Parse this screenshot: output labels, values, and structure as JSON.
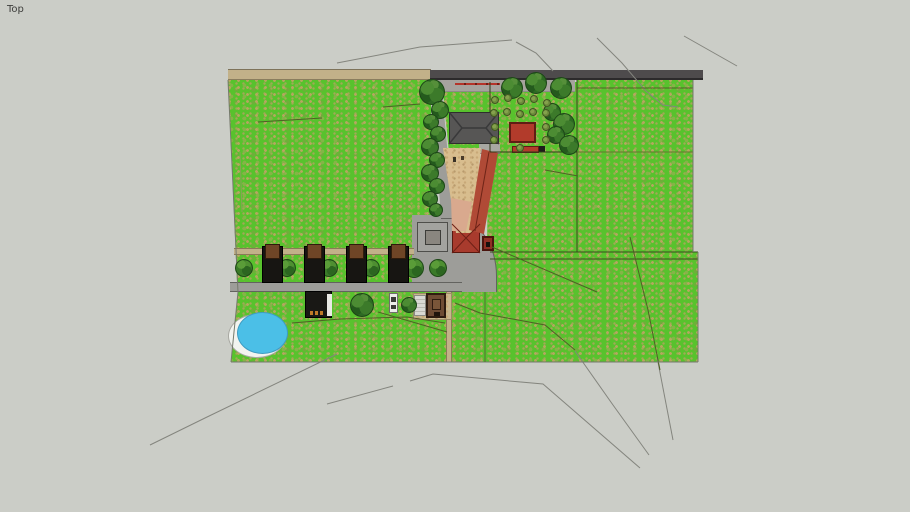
{
  "viewport": {
    "label": "Top"
  },
  "colors": {
    "background": "#cbcdc7",
    "label": "#3e3e3c",
    "grass": "#58c22d",
    "dirt_road": "#c2b189",
    "asphalt": "#4e4b4c",
    "road_gray": "#9d9d99",
    "pavement": "#a6a39e",
    "roof_gray": "#575655",
    "barn_red": "#b23b2b",
    "roof_red_light": "#cf8b74",
    "roof_red": "#b04a36",
    "courtyard_tan": "#d8bd8e",
    "terrace_pink": "#d9a98e",
    "pool_blue": "#4bbfe7",
    "shrub_olive": "#6e8c3c",
    "stall_black": "#171512",
    "stall_brown": "#6f4526",
    "kiosk_brown": "#6e4c34"
  },
  "scene": {
    "trees": [
      {
        "x": 432,
        "y": 92,
        "r": 13
      },
      {
        "x": 440,
        "y": 110,
        "r": 9
      },
      {
        "x": 431,
        "y": 122,
        "r": 8
      },
      {
        "x": 438,
        "y": 134,
        "r": 8
      },
      {
        "x": 430,
        "y": 147,
        "r": 9
      },
      {
        "x": 437,
        "y": 160,
        "r": 8
      },
      {
        "x": 430,
        "y": 173,
        "r": 9
      },
      {
        "x": 437,
        "y": 186,
        "r": 8
      },
      {
        "x": 430,
        "y": 199,
        "r": 8
      },
      {
        "x": 436,
        "y": 210,
        "r": 7
      },
      {
        "x": 512,
        "y": 88,
        "r": 11
      },
      {
        "x": 536,
        "y": 83,
        "r": 11
      },
      {
        "x": 561,
        "y": 88,
        "r": 11
      },
      {
        "x": 552,
        "y": 112,
        "r": 9
      },
      {
        "x": 564,
        "y": 124,
        "r": 11
      },
      {
        "x": 556,
        "y": 135,
        "r": 9
      },
      {
        "x": 569,
        "y": 145,
        "r": 10
      },
      {
        "x": 362,
        "y": 305,
        "r": 12
      },
      {
        "x": 409,
        "y": 305,
        "r": 8
      }
    ],
    "bushes": [
      {
        "x": 244,
        "y": 268,
        "r": 9
      },
      {
        "x": 287,
        "y": 268,
        "r": 9
      },
      {
        "x": 329,
        "y": 268,
        "r": 9
      },
      {
        "x": 371,
        "y": 268,
        "r": 9
      },
      {
        "x": 414,
        "y": 268,
        "r": 10
      },
      {
        "x": 438,
        "y": 268,
        "r": 9
      }
    ],
    "shrubs": [
      {
        "x": 495,
        "y": 100
      },
      {
        "x": 508,
        "y": 98
      },
      {
        "x": 521,
        "y": 101
      },
      {
        "x": 534,
        "y": 99
      },
      {
        "x": 547,
        "y": 103
      },
      {
        "x": 494,
        "y": 113
      },
      {
        "x": 507,
        "y": 112
      },
      {
        "x": 520,
        "y": 114
      },
      {
        "x": 533,
        "y": 112
      },
      {
        "x": 546,
        "y": 113
      },
      {
        "x": 495,
        "y": 127
      },
      {
        "x": 546,
        "y": 127
      },
      {
        "x": 494,
        "y": 140
      },
      {
        "x": 546,
        "y": 140
      },
      {
        "x": 520,
        "y": 148
      }
    ],
    "stalls": [
      {
        "x": 262
      },
      {
        "x": 304
      },
      {
        "x": 346
      },
      {
        "x": 388
      }
    ],
    "lines": {
      "background": [
        {
          "points": [
            [
              337,
              63
            ],
            [
              420,
              47
            ],
            [
              512,
              40
            ]
          ]
        },
        {
          "points": [
            [
              516,
              42
            ],
            [
              536,
              53
            ],
            [
              553,
              71
            ]
          ]
        },
        {
          "points": [
            [
              597,
              38
            ],
            [
              622,
              63
            ],
            [
              646,
              91
            ],
            [
              663,
              105
            ],
            [
              678,
              107
            ]
          ]
        },
        {
          "points": [
            [
              684,
              36
            ],
            [
              737,
              66
            ]
          ]
        },
        {
          "points": [
            [
              150,
              445
            ],
            [
              205,
              418
            ],
            [
              337,
              354
            ]
          ]
        },
        {
          "points": [
            [
              327,
              404
            ],
            [
              393,
              386
            ]
          ]
        },
        {
          "points": [
            [
              410,
              381
            ],
            [
              433,
              374
            ],
            [
              543,
              384
            ],
            [
              640,
              468
            ]
          ]
        },
        {
          "points": [
            [
              657,
              357
            ],
            [
              673,
              440
            ]
          ]
        },
        {
          "points": [
            [
              575,
              351
            ],
            [
              613,
              405
            ],
            [
              649,
              455
            ]
          ]
        }
      ],
      "grass": [
        {
          "points": [
            [
              577,
              88
            ],
            [
              693,
              88
            ]
          ]
        },
        {
          "points": [
            [
              490,
              252
            ],
            [
              698,
              252
            ]
          ],
          "stroke": "#3c4a1e"
        },
        {
          "points": [
            [
              490,
              259
            ],
            [
              698,
              259
            ]
          ],
          "stroke": "#3c4a1e"
        },
        {
          "points": [
            [
              490,
              82
            ],
            [
              490,
              112
            ]
          ],
          "stroke": "#2f3a18"
        },
        {
          "points": [
            [
              490,
              144
            ],
            [
              490,
              152
            ]
          ],
          "stroke": "#2f3a18"
        },
        {
          "points": [
            [
              490,
              152
            ],
            [
              577,
              152
            ]
          ],
          "stroke": "#2f3a18"
        },
        {
          "points": [
            [
              577,
              80
            ],
            [
              577,
              252
            ]
          ],
          "stroke": "#3c4a1e"
        },
        {
          "points": [
            [
              577,
              152
            ],
            [
              693,
              152
            ]
          ],
          "stroke": "#66762f"
        },
        {
          "points": [
            [
              258,
              122
            ],
            [
              322,
              118
            ]
          ]
        },
        {
          "points": [
            [
              383,
              107
            ],
            [
              420,
              104
            ]
          ]
        },
        {
          "points": [
            [
              545,
              170
            ],
            [
              578,
              176
            ]
          ]
        },
        {
          "points": [
            [
              492,
              247
            ],
            [
              597,
              292
            ]
          ]
        },
        {
          "points": [
            [
              630,
              237
            ],
            [
              648,
              310
            ],
            [
              660,
              370
            ]
          ]
        },
        {
          "points": [
            [
              455,
              303
            ],
            [
              480,
              313
            ],
            [
              545,
              325
            ],
            [
              575,
              350
            ]
          ]
        },
        {
          "points": [
            [
              292,
              323
            ],
            [
              340,
              319
            ],
            [
              407,
              317
            ],
            [
              445,
              323
            ]
          ]
        },
        {
          "points": [
            [
              378,
              312
            ],
            [
              447,
              332
            ]
          ]
        }
      ],
      "edges": [
        {
          "points": [
            [
              228,
              80
            ],
            [
              238,
              292
            ],
            [
              231,
              362
            ]
          ]
        },
        {
          "points": [
            [
              231,
              362
            ],
            [
              698,
              362
            ]
          ]
        },
        {
          "points": [
            [
              693,
              80
            ],
            [
              693,
              252
            ]
          ]
        },
        {
          "points": [
            [
              698,
              252
            ],
            [
              698,
              362
            ]
          ]
        },
        {
          "points": [
            [
              485,
              292
            ],
            [
              485,
              362
            ]
          ],
          "stroke": "#5a6a38"
        },
        {
          "points": [
            [
              240,
              152
            ],
            [
              242,
              212
            ]
          ],
          "stroke": "#8aa05a"
        }
      ]
    }
  }
}
